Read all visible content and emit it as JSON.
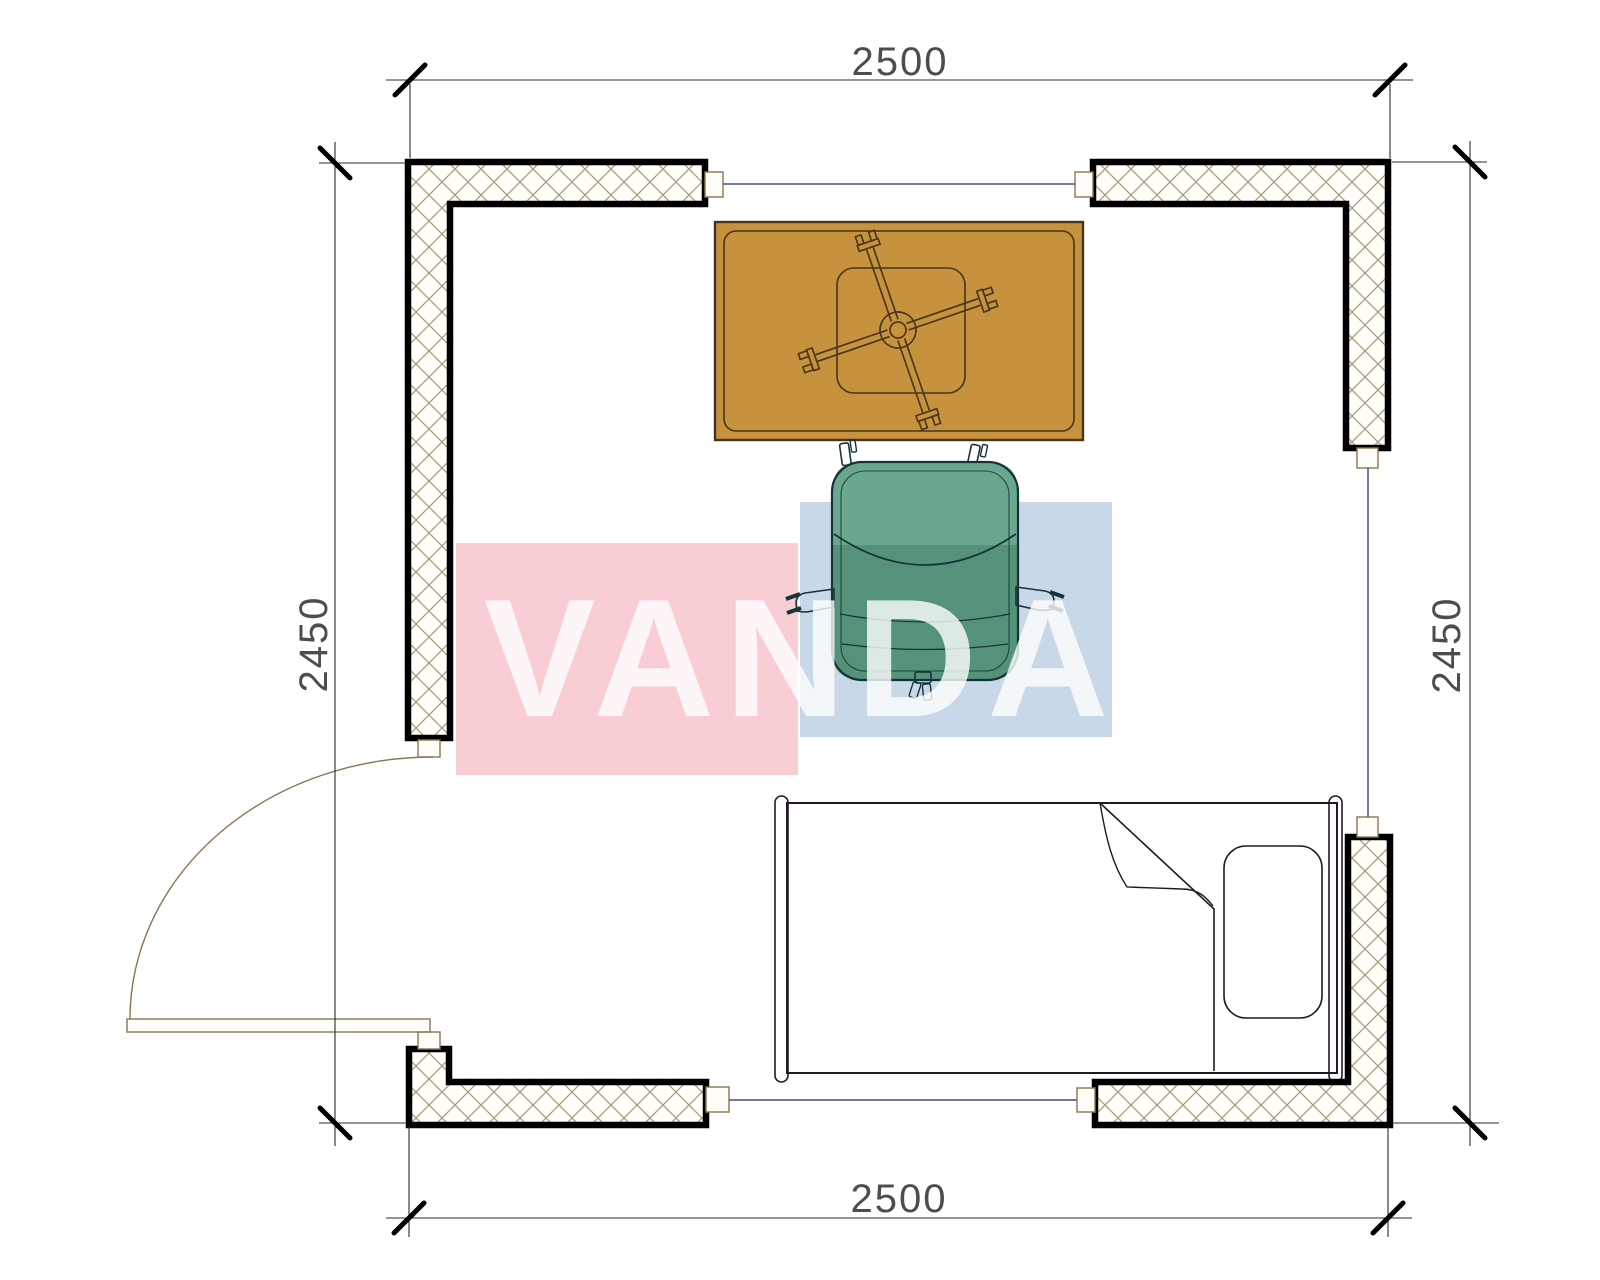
{
  "dimensions": {
    "top_label": "2500",
    "bottom_label": "2500",
    "left_label": "2450",
    "right_label": "2450"
  },
  "watermark": {
    "text": "VANDA",
    "pink_block": "#f9cdd4",
    "blue_block": "#c9d8e8"
  },
  "colors": {
    "wall_hatch_line": "#a79878",
    "wall_outline": "#000000",
    "table_fill": "#c6923e",
    "chair_top": "#6aa88e",
    "chair_body": "#5b9a7f",
    "chair_seat": "#549379",
    "bed_fill": "#a48b97",
    "door_line": "#8a7550",
    "window_line": "#4a4f78"
  }
}
